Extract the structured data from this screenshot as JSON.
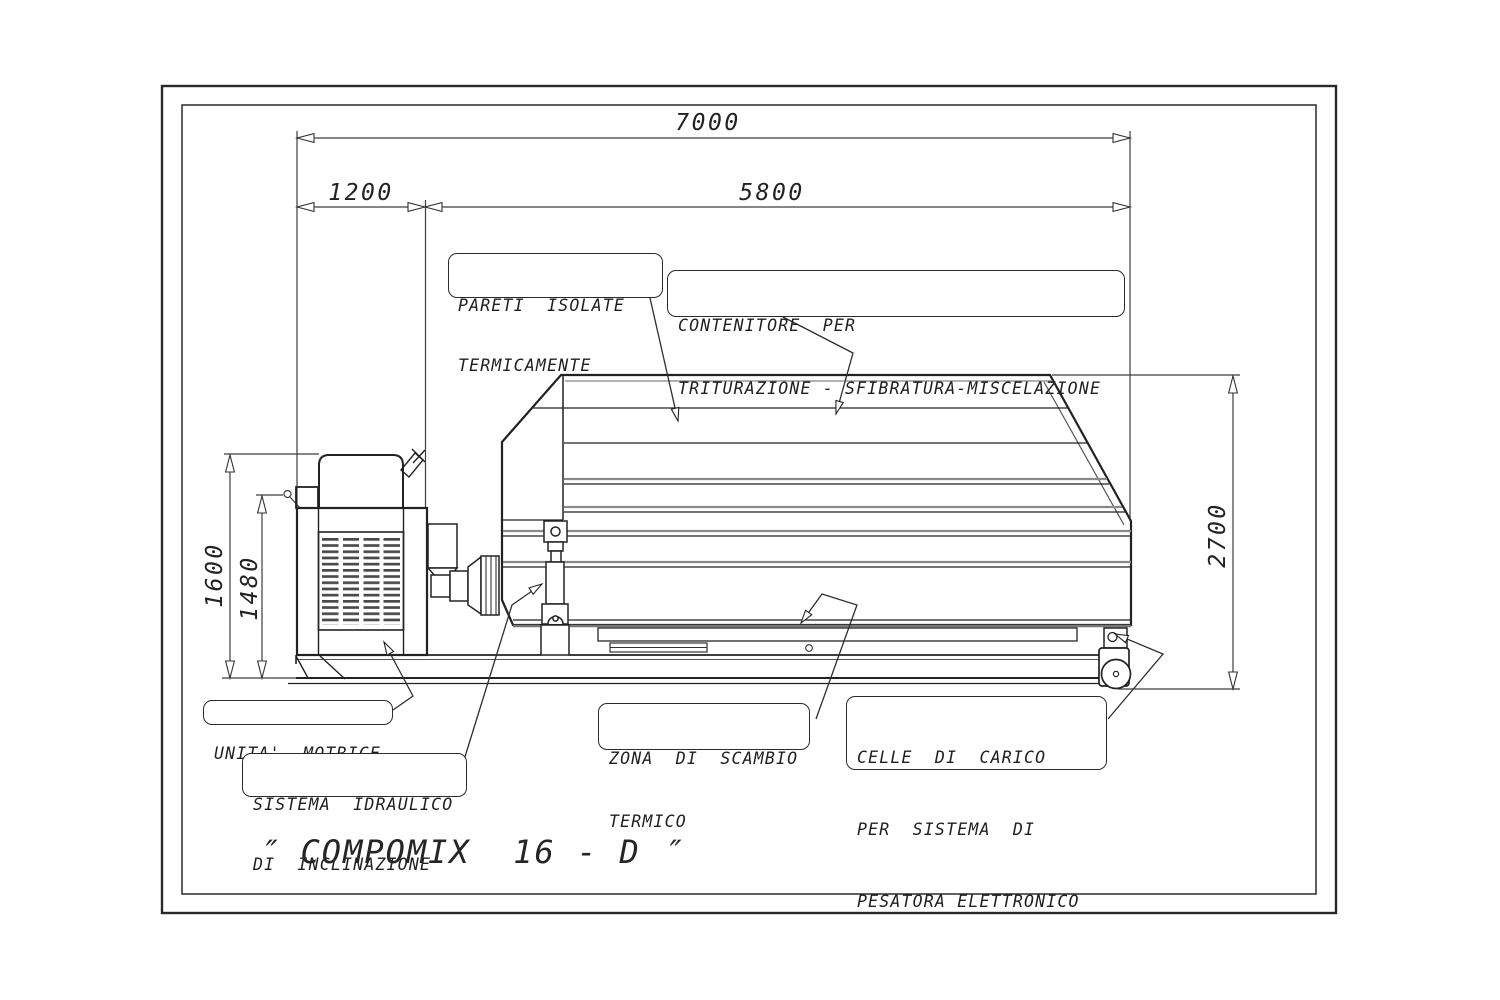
{
  "sheet": {
    "machine_title": "″ COMPOMIX  16 - D ″"
  },
  "dimensions": {
    "total_length": "7000",
    "motor_section_length": "1200",
    "container_section_length": "5800",
    "motor_height": "1600",
    "frame_height": "1480",
    "container_height": "2700"
  },
  "annotations": {
    "insulated_walls": {
      "line1": "PARETI  ISOLATE",
      "line2": "TERMICAMENTE"
    },
    "container": {
      "line1": "CONTENITORE  PER",
      "line2": "TRITURAZIONE - SFIBRATURA-MISCELAZIONE"
    },
    "drive_unit": {
      "line1": "UNITA'  MOTRICE"
    },
    "hydraulic_system": {
      "line1": "SISTEMA  IDRAULICO",
      "line2": "DI  INCLINAZIONE"
    },
    "heat_exchange": {
      "line1": "ZONA  DI  SCAMBIO",
      "line2": "TERMICO"
    },
    "load_cells": {
      "line1": "CELLE  DI  CARICO",
      "line2": "PER  SISTEMA  DI",
      "line3": "PESATORA ELETTRONICO"
    }
  },
  "colors": {
    "line": "#1a1a1a",
    "background": "#ffffff"
  }
}
